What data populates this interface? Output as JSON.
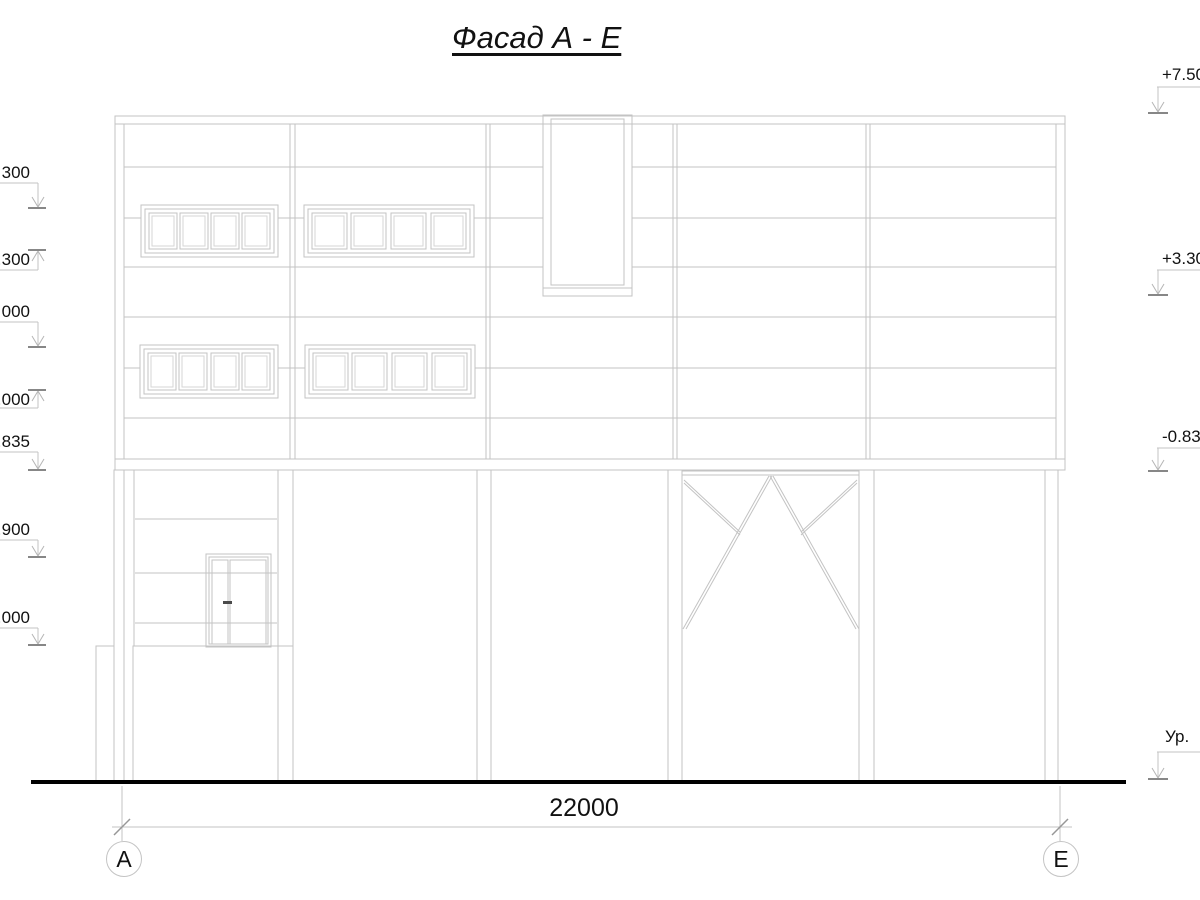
{
  "title": "Фасад А - Е",
  "dimension": {
    "label": "22000"
  },
  "axis_markers": {
    "left": "А",
    "right": "Е"
  },
  "elevation_marks_left": [
    {
      "label": "300",
      "direction": "down"
    },
    {
      "label": ".300",
      "direction": "up"
    },
    {
      "label": "000",
      "direction": "down"
    },
    {
      "label": ".000",
      "direction": "up"
    },
    {
      "label": ".835",
      "direction": "down"
    },
    {
      "label": ".900",
      "direction": "down"
    },
    {
      "label": ".000",
      "direction": "down"
    }
  ],
  "elevation_marks_right": [
    {
      "label": "+7.50",
      "direction": "down"
    },
    {
      "label": "+3.30",
      "direction": "down"
    },
    {
      "label": "-0.83",
      "direction": "down"
    },
    {
      "label": "Ур.",
      "direction": "down"
    }
  ],
  "colors": {
    "drawing_line": "#c3c3c3",
    "ground_line": "#000000",
    "text": "#111111",
    "background": "#ffffff"
  }
}
